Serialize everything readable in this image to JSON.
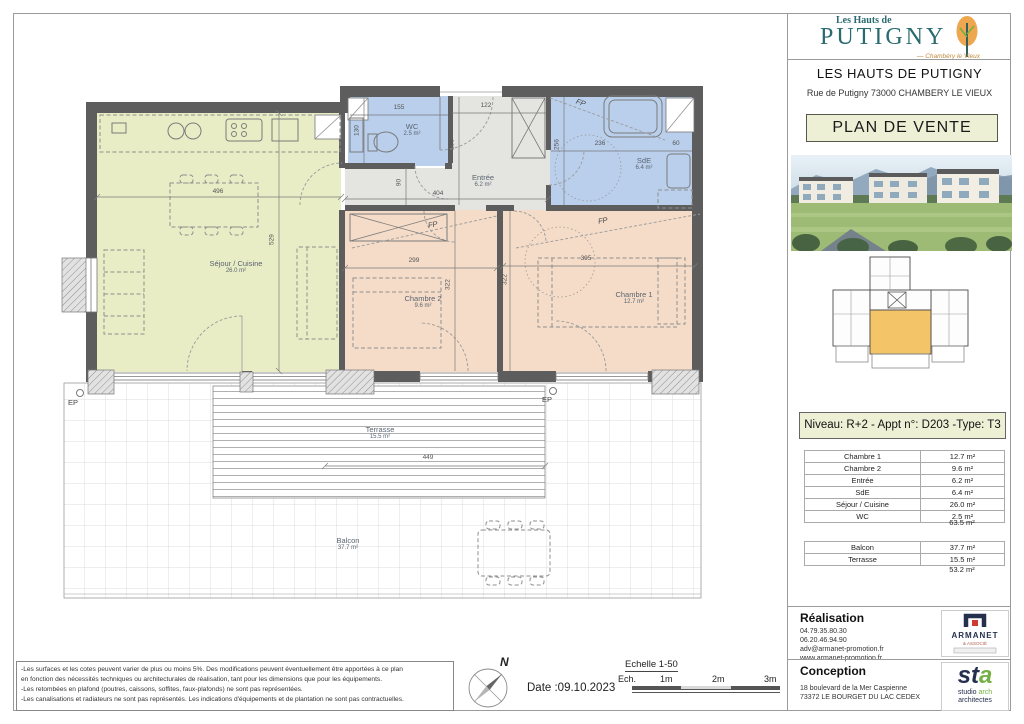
{
  "brand": {
    "logo_top": "Les Hauts de",
    "logo_name": "PUTIGNY",
    "logo_sub": "— Chambéry le Vieux",
    "title": "LES HAUTS DE PUTIGNY",
    "address": "Rue de Putigny 73000 CHAMBERY LE VIEUX",
    "doc_title": "PLAN DE VENTE"
  },
  "unit": {
    "banner": "Niveau: R+2  - Appt n°: D203 -Type: T3"
  },
  "surfaces": {
    "rooms": [
      {
        "name": "Chambre 1",
        "area": "12.7 m²"
      },
      {
        "name": "Chambre 2",
        "area": "9.6 m²"
      },
      {
        "name": "Entrée",
        "area": "6.2 m²"
      },
      {
        "name": "SdE",
        "area": "6.4 m²"
      },
      {
        "name": "Séjour / Cuisine",
        "area": "26.0 m²"
      },
      {
        "name": "WC",
        "area": "2.5 m²"
      }
    ],
    "rooms_total": "63.5 m²",
    "outdoor": [
      {
        "name": "Balcon",
        "area": "37.7 m²"
      },
      {
        "name": "Terrasse",
        "area": "15.5 m²"
      }
    ],
    "outdoor_total": "53.2 m²"
  },
  "realisation": {
    "title": "Réalisation",
    "phone1": "04.79.35.80.30",
    "phone2": "06.20.46.94.90",
    "email": "adv@armanet-promotion.fr",
    "website": "www.armanet-promotion.fr",
    "logo_name": "ARMANET",
    "logo_sub": "& ASSOCIÉ"
  },
  "conception": {
    "title": "Conception",
    "address1": "18 boulevard de la Mer Caspienne",
    "address2": "73372 LE BOURGET DU LAC CEDEX",
    "logo_st": "st",
    "logo_a": "a",
    "logo_line1_a": "studio ",
    "logo_line1_b": "arch",
    "logo_line2": "architectes"
  },
  "footer": {
    "disclaimer": [
      "-Les surfaces et les cotes peuvent varier de plus ou moins 5%. Des modifications peuvent éventuellement être apportées à ce plan",
      "en fonction des nécessités techniques ou architecturales de réalisation, tant pour les dimensions que pour les équipements.",
      "-Les retombées en plafond (poutres, caissons, soffites, faux-plafonds) ne sont pas représentées.",
      "-Les canalisations et radiateurs ne sont pas représentés. Les indications d'équipements et de plantation ne sont pas contractuelles."
    ],
    "date": "Date :09.10.2023",
    "north": "N",
    "scale_title": "Echelle 1-50",
    "scale_prefix": "Ech.",
    "scale_marks": [
      "1m",
      "2m",
      "3m"
    ]
  },
  "plan": {
    "rooms": {
      "sejour": {
        "name": "Séjour / Cuisine",
        "area": "26.0 m²"
      },
      "chambre1": {
        "name": "Chambre 1",
        "area": "12.7 m²"
      },
      "chambre2": {
        "name": "Chambre 2",
        "area": "9.6 m²"
      },
      "entree": {
        "name": "Entrée",
        "area": "6.2 m²"
      },
      "wc": {
        "name": "WC",
        "area": "2.5 m²"
      },
      "sde": {
        "name": "SdE",
        "area": "6.4 m²"
      },
      "terrasse": {
        "name": "Terrasse",
        "area": "15.5 m²"
      },
      "balcon": {
        "name": "Balcon",
        "area": "37.7 m²"
      }
    },
    "dims": {
      "sejour_w": "496",
      "sejour_h": "529",
      "wc_w": "155",
      "wc_h": "130",
      "entree_top": "122",
      "entree_h": "236",
      "entree_w": "404",
      "entree_small": "90",
      "sde_w": "236",
      "sde_h": "256",
      "sde_sink": "60",
      "chambre2_w": "299",
      "chambre2_h": "322",
      "chambre1_w": "395",
      "chambre1_h": "322",
      "terrasse_w": "449"
    },
    "marks": {
      "ep": "EP",
      "fp": "FP"
    }
  },
  "colors": {
    "sejour": "#e9edc6",
    "bedroom": "#f5dcc8",
    "wet": "#b9cfec",
    "hall": "#e4e4e1",
    "wall": "#5d5d5d",
    "banner_bg": "#eef0d6",
    "highlight": "#f4c468",
    "brand_teal": "#2a6b70",
    "brand_orange": "#eea74f",
    "logo_navy": "#25304e",
    "logo_red": "#cf3b33",
    "logo_green": "#74b043"
  }
}
